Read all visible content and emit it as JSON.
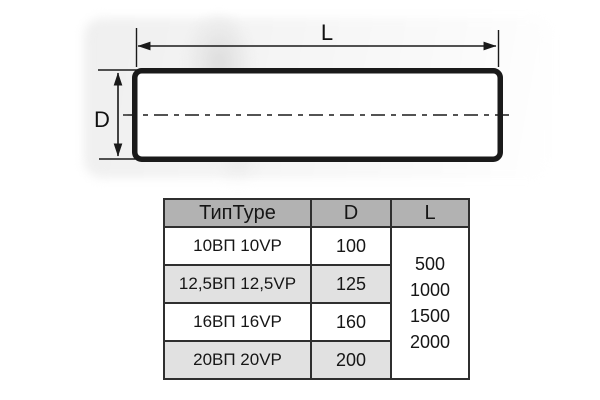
{
  "diagram": {
    "length_label": "L",
    "diameter_label": "D"
  },
  "table": {
    "headers": {
      "type": "ТипType",
      "d": "D",
      "l": "L"
    },
    "rows": [
      {
        "type": "10ВП 10VP",
        "d": "100"
      },
      {
        "type": "12,5ВП 12,5VP",
        "d": "125"
      },
      {
        "type": "16ВП 16VP",
        "d": "160"
      },
      {
        "type": "20ВП 20VP",
        "d": "200"
      }
    ],
    "l_values": [
      "500",
      "1000",
      "1500",
      "2000"
    ]
  },
  "colors": {
    "line": "#1a1a1a",
    "table_header_bg": "#b2b2b2",
    "table_stripe_bg": "#e1e1e1",
    "table_border": "#2f2f2f",
    "background": "#ffffff"
  }
}
